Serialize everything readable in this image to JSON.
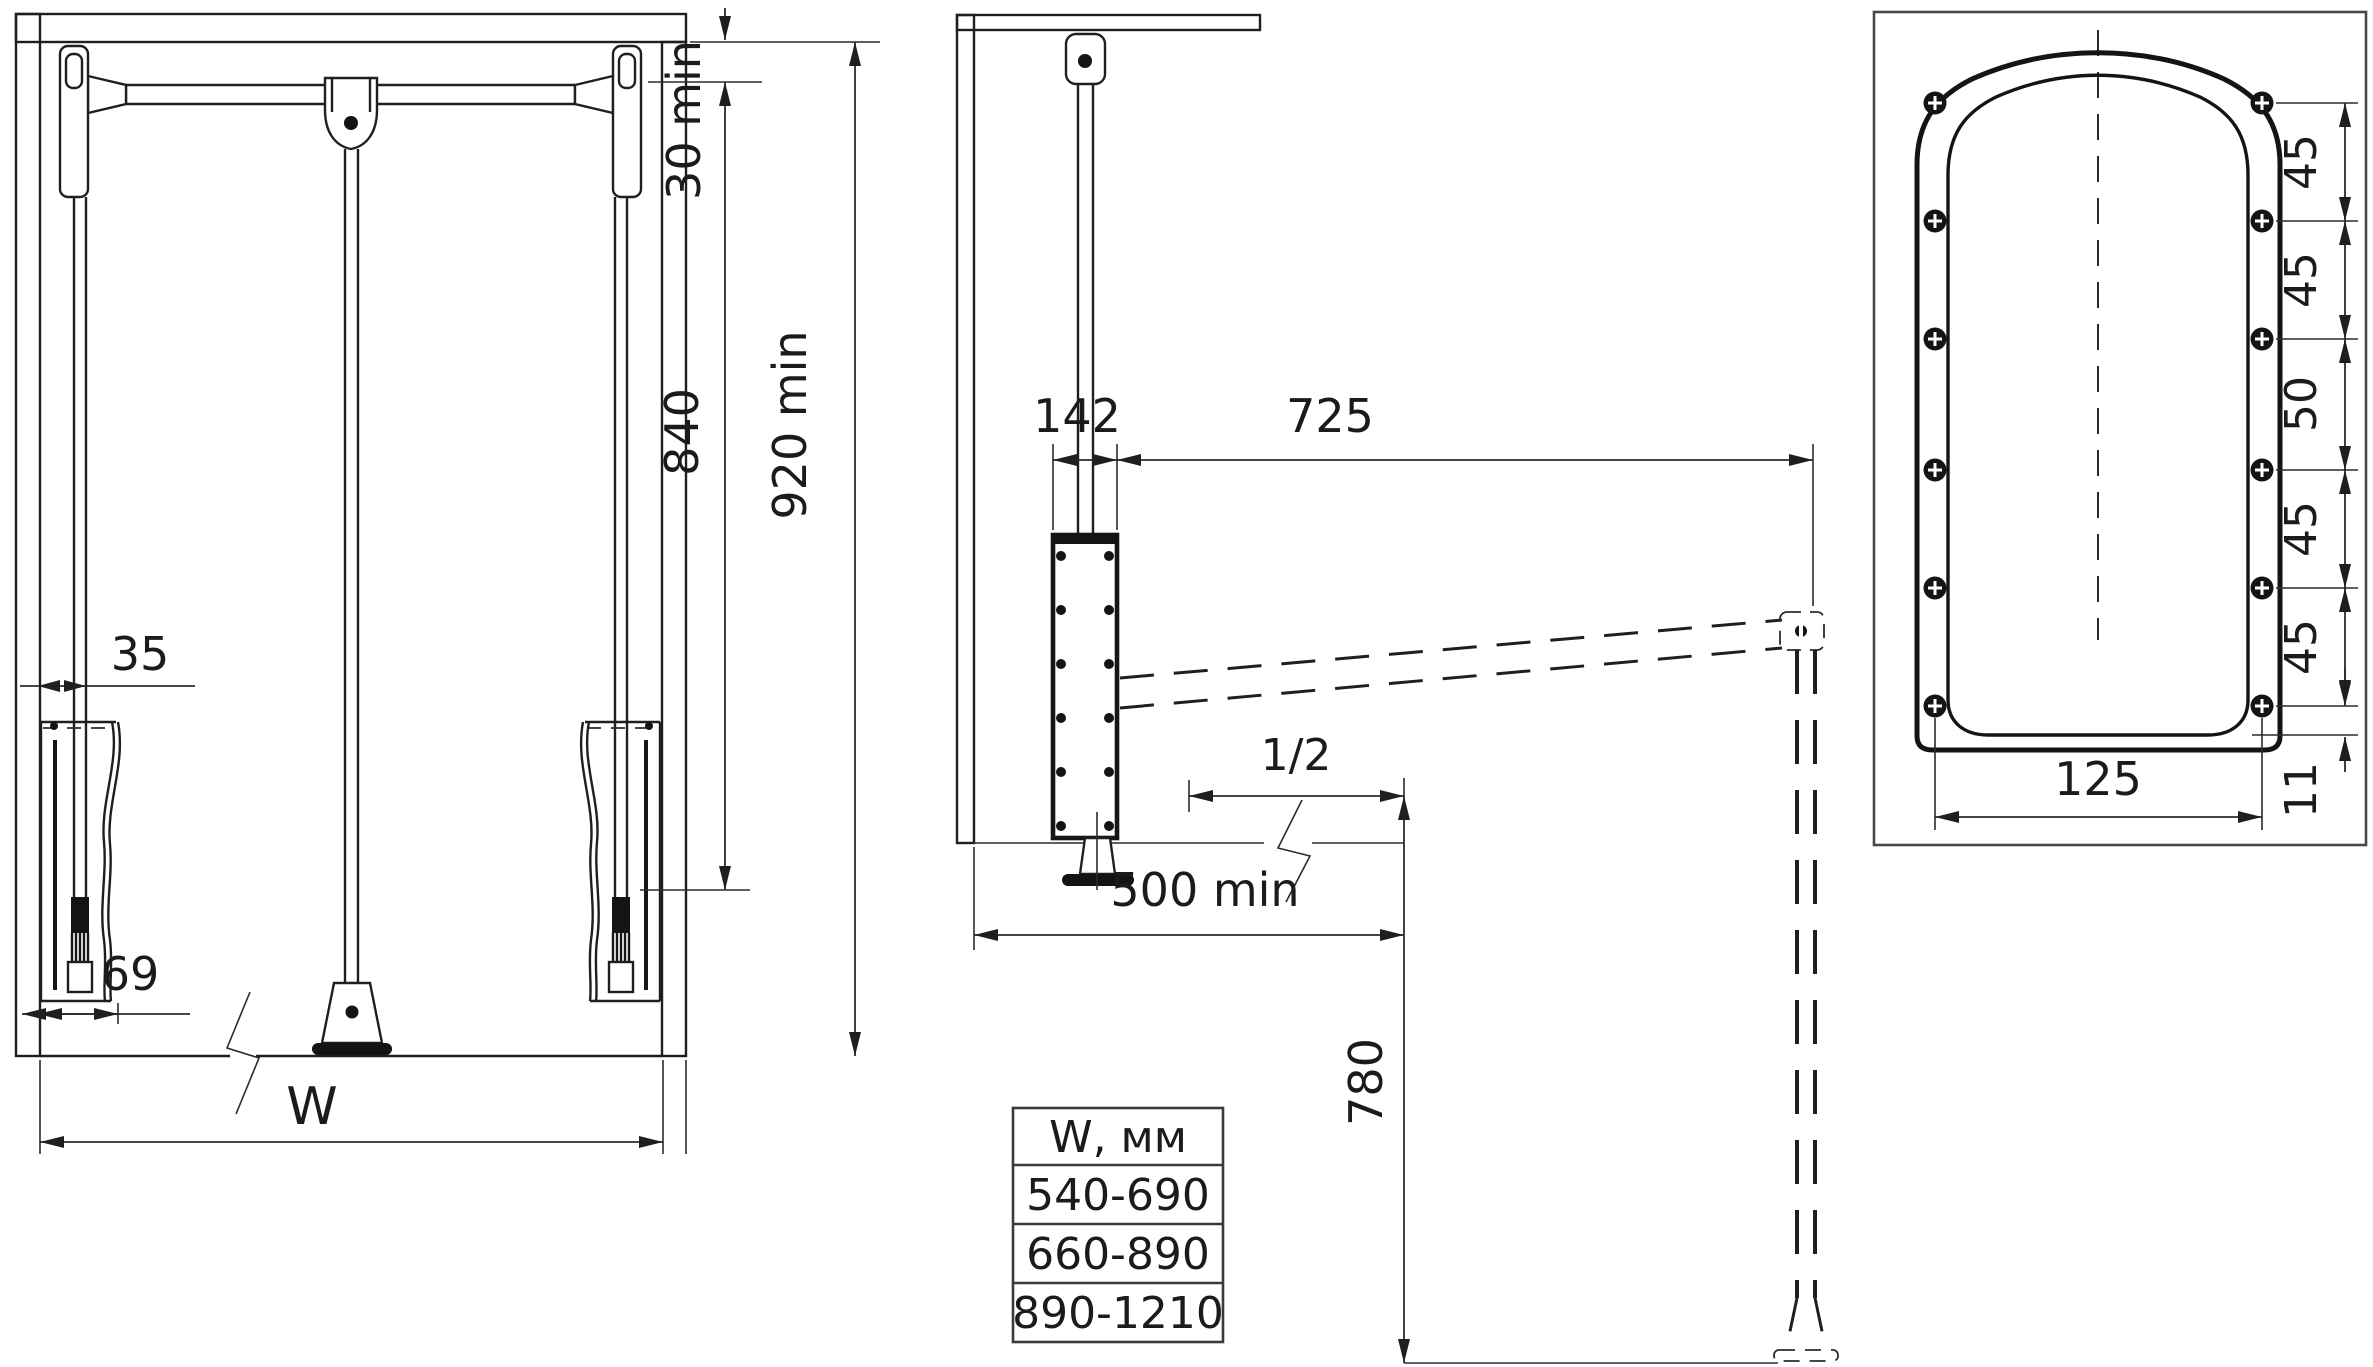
{
  "front_view": {
    "top_clearance": "30 min",
    "min_height": "920 min",
    "arm_drop": "840",
    "wall_clearance": "35",
    "bracket_depth": "69",
    "width": "W"
  },
  "side_view": {
    "body_depth": "142",
    "extension_reach": "725",
    "half_depth": "1/2",
    "min_depth": "500 min",
    "lowered_height": "780"
  },
  "plate_view": {
    "hole_pitches": [
      "45",
      "45",
      "50",
      "45",
      "45"
    ],
    "bottom_hole_offset": "11",
    "hole_span": "125"
  },
  "width_table": {
    "header": "W, мм",
    "rows": [
      "540-690",
      "660-890",
      "890-1210"
    ]
  },
  "colors": {
    "line": "#1f1f1f",
    "background": "#ffffff"
  }
}
